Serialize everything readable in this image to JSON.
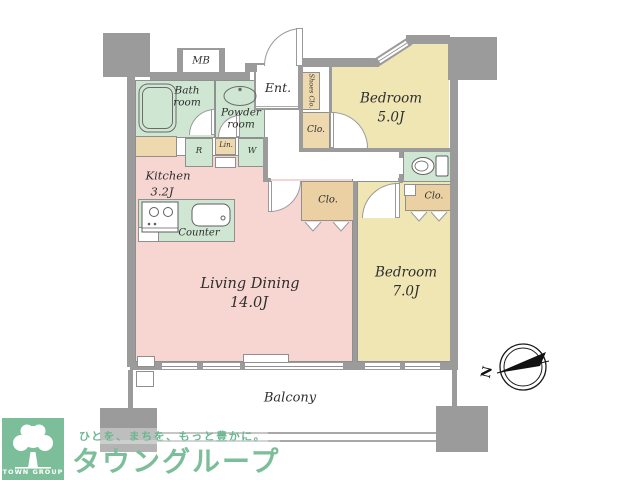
{
  "colors": {
    "wall": "#9b9b9b",
    "room_green": "#cfe7d2",
    "room_pink": "#f7d6d2",
    "room_yellow": "#f0e6b4",
    "closet_tan": "#eed9ae",
    "closet_orange": "#ead0a2",
    "brand_green": "#7cbe99",
    "tagline_green": "#68b78f",
    "line": "#8f8f8f",
    "text": "#2e2e2e"
  },
  "rooms": {
    "living_dining": {
      "label": "Living Dining",
      "size": "14.0J"
    },
    "kitchen": {
      "label": "Kitchen",
      "size": "3.2J"
    },
    "bedroom5": {
      "label": "Bedroom",
      "size": "5.0J"
    },
    "bedroom7": {
      "label": "Bedroom",
      "size": "7.0J"
    },
    "bath": {
      "label": "Bath room"
    },
    "powder": {
      "label": "Powder room"
    },
    "entrance": {
      "label": "Ent."
    },
    "balcony": {
      "label": "Balcony"
    },
    "counter": {
      "label": "Counter"
    },
    "meter_box": {
      "label": "MB"
    },
    "shoes_closet": {
      "label": "Shoes Clo."
    },
    "closet_bedroom5": {
      "label": "Clo."
    },
    "closet_living": {
      "label": "Clo."
    },
    "closet_bedroom7": {
      "label": "Clo."
    },
    "refrigerator": {
      "label": "R"
    },
    "linen": {
      "label": "Lin."
    },
    "washer": {
      "label": "W"
    }
  },
  "compass": {
    "label": "N"
  },
  "watermark": {
    "tagline": "ひとを、まちを、もっと豊かに。",
    "brand": "タウングループ",
    "logo_text": "TOWN GROUP"
  }
}
